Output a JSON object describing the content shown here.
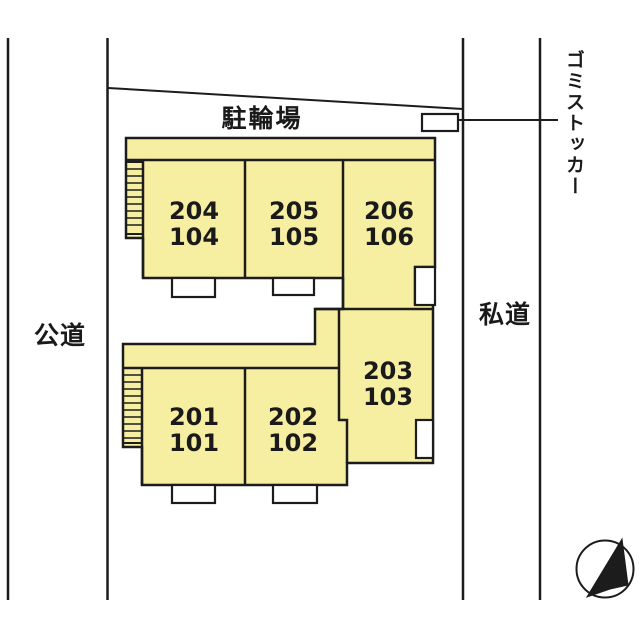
{
  "labels": {
    "bicycle_parking": "駐輪場",
    "public_road": "公道",
    "private_road": "私道",
    "garbage_stocker": "ゴミストッカー"
  },
  "units": [
    {
      "upper": "204",
      "lower": "104"
    },
    {
      "upper": "205",
      "lower": "105"
    },
    {
      "upper": "206",
      "lower": "106"
    },
    {
      "upper": "203",
      "lower": "103"
    },
    {
      "upper": "201",
      "lower": "101"
    },
    {
      "upper": "202",
      "lower": "102"
    }
  ],
  "icons": {
    "north_arrow": "compass-north-arrow",
    "garbage_box": "garbage-stocker-box",
    "stairs": "staircase-hatch"
  },
  "colors": {
    "building_fill": "#F6EFA2",
    "line": "#1C1C1C",
    "background": "#FFFFFF"
  }
}
